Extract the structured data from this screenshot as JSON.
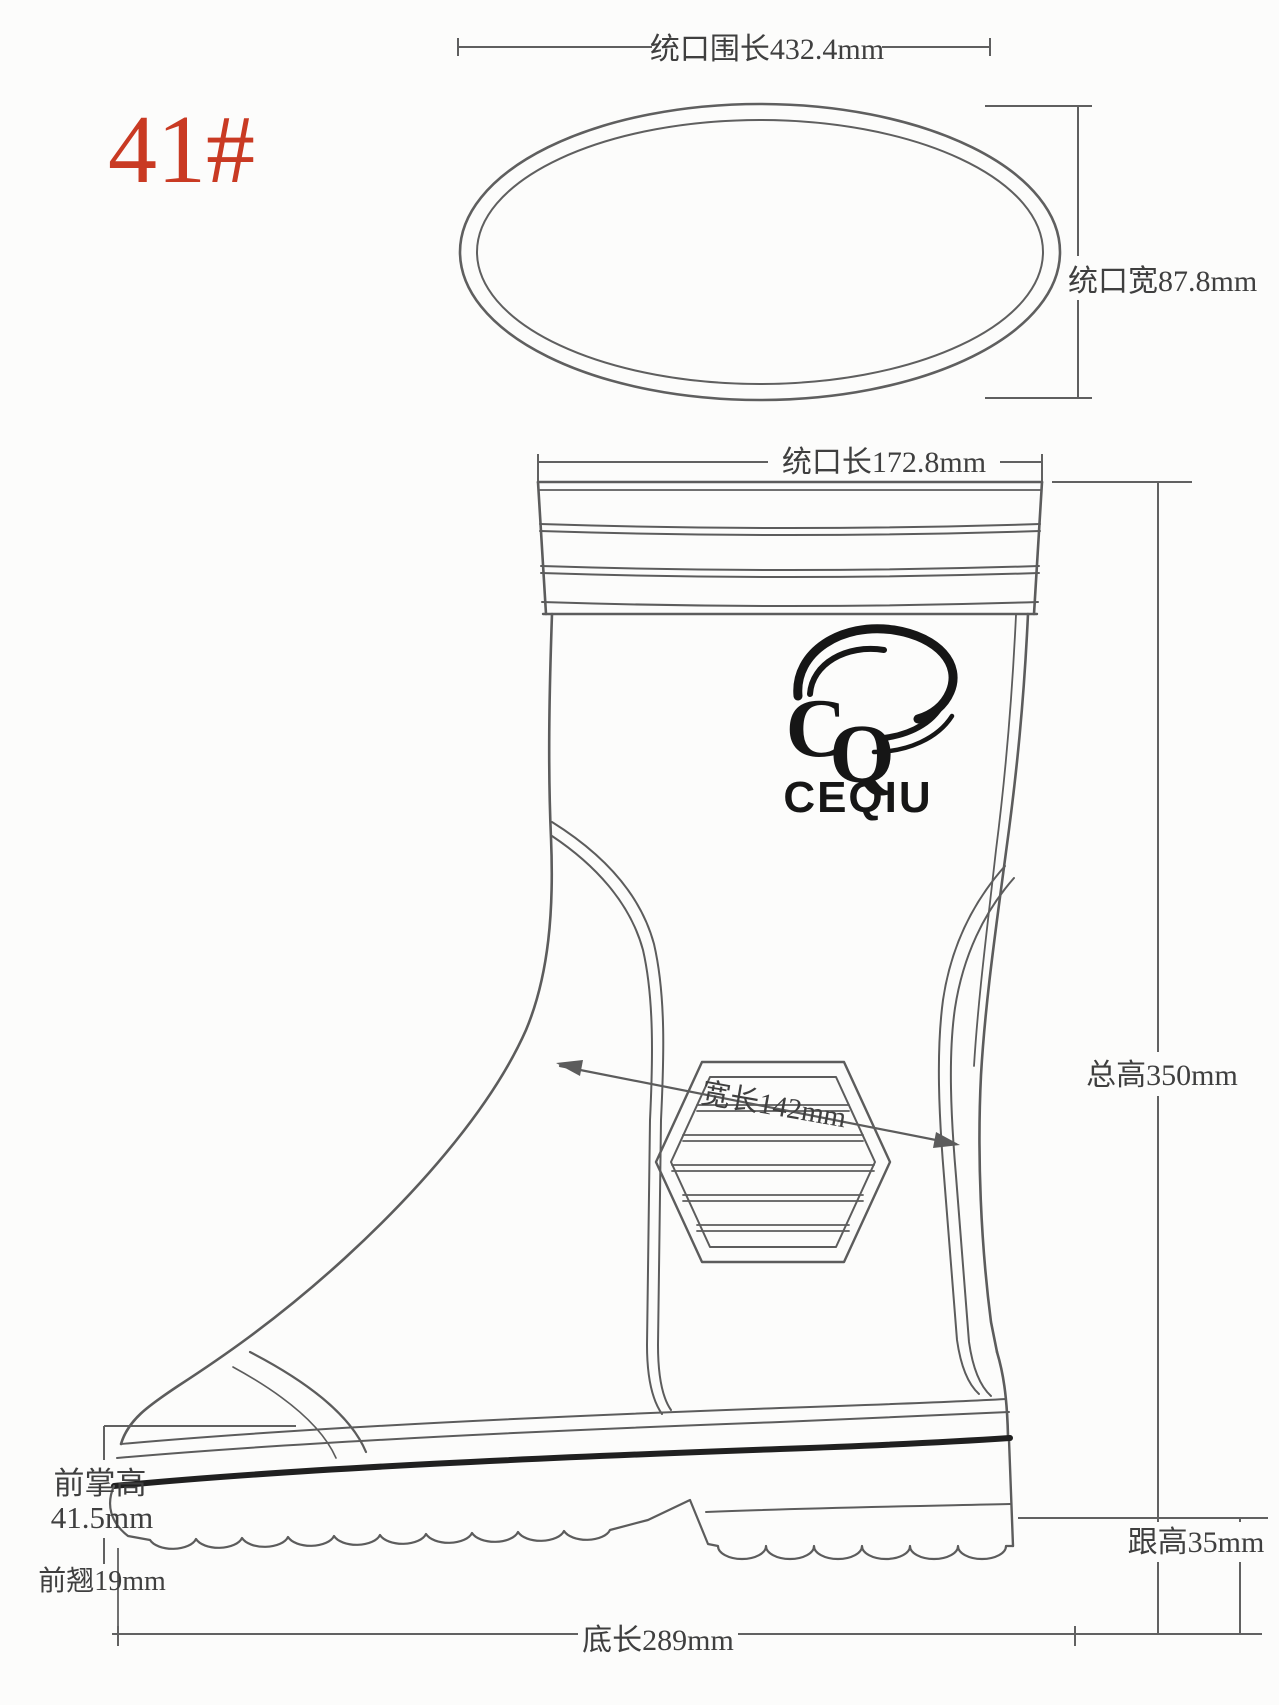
{
  "meta": {
    "size_label": "41#"
  },
  "colors": {
    "accent_red": "#c93a23",
    "line": "#5f5f5f",
    "text": "#3f3f3f",
    "dark": "#1a1a1a"
  },
  "top_view": {
    "circumference_label": "统口围长432.4mm",
    "width_label": "统口宽87.8mm"
  },
  "side_view": {
    "opening_length_label": "统口长172.8mm",
    "total_height_label": "总高350mm",
    "width_length_label": "宽长142mm",
    "forefoot_height_label": "前掌高",
    "forefoot_height_value": "41.5mm",
    "toe_spring_label": "前翘19mm",
    "heel_height_label": "跟高35mm",
    "sole_length_label": "底长289mm"
  },
  "logo": {
    "letter_c": "C",
    "letter_q": "Q",
    "brand": "CEQIU"
  }
}
